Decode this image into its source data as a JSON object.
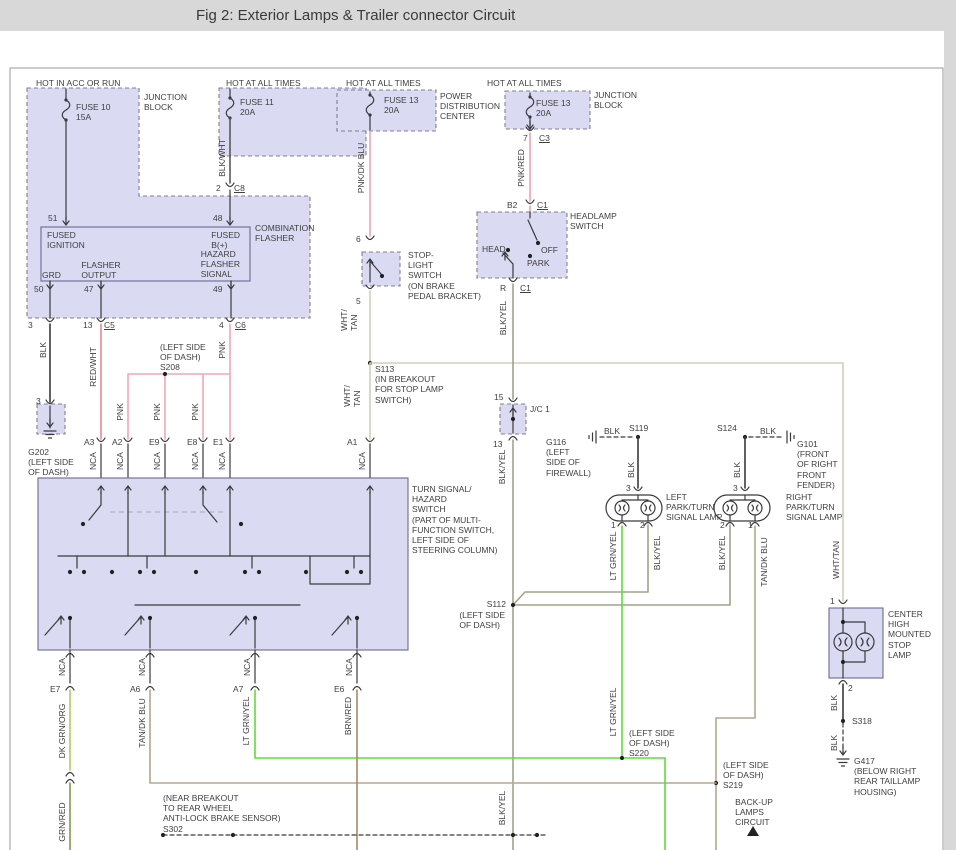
{
  "header": {
    "title": "Fig 2: Exterior Lamps & Trailer connector Circuit"
  },
  "colors": {
    "lav": "#dadaf2",
    "blk": "#3a3a3a",
    "bw": "#5a5a5a",
    "pnk": "#f0a6b4",
    "prd": "#efa0a8",
    "pdb": "#eda4b8",
    "rw": "#ea8890",
    "wt": "#d5cdb6",
    "by": "#a2a28c",
    "tdb": "#b5a78c",
    "lgy": "#5bdd3a",
    "dgo": "#a4d05c",
    "brd": "#ab8a5c",
    "gr2": "#7d9c46"
  },
  "labels": [
    {
      "n": "figure-title",
      "t": "Fig 2: Exterior Lamps & Trailer connector Circuit",
      "x": 196,
      "y": 7,
      "big": 1
    },
    {
      "n": "hot-in-acc-or-run",
      "t": "HOT IN ACC OR RUN",
      "x": 36,
      "y": 78
    },
    {
      "n": "junction-block-1",
      "t": "JUNCTION\nBLOCK",
      "x": 144,
      "y": 92
    },
    {
      "n": "fuse-10",
      "t": "FUSE 10\n15A",
      "x": 76,
      "y": 102
    },
    {
      "n": "hot-at-all-times-1",
      "t": "HOT AT ALL TIMES",
      "x": 226,
      "y": 78
    },
    {
      "n": "fuse-11",
      "t": "FUSE 11\n20A",
      "x": 240,
      "y": 97
    },
    {
      "n": "wire-blk-wht",
      "t": "BLK/WHT",
      "x": 222,
      "y": 158,
      "r": 1
    },
    {
      "n": "pin-2",
      "t": "2",
      "x": 216,
      "y": 183
    },
    {
      "n": "conn-c8",
      "t": "C8",
      "x": 234,
      "y": 183,
      "u": 1
    },
    {
      "n": "pin-51",
      "t": "51",
      "x": 48,
      "y": 213
    },
    {
      "n": "pin-48",
      "t": "48",
      "x": 213,
      "y": 213
    },
    {
      "n": "combination-flasher",
      "t": "COMBINATION\nFLASHER",
      "x": 255,
      "y": 223
    },
    {
      "n": "fused-ignition",
      "t": "FUSED\nIGNITION",
      "x": 47,
      "y": 230
    },
    {
      "n": "fused-b-plus",
      "t": "FUSED\nB(+)",
      "x": 240,
      "y": 230,
      "a": "r"
    },
    {
      "n": "hazard-flasher-signal",
      "t": "HAZARD\nFLASHER\nSIGNAL",
      "x": 240,
      "y": 249,
      "a": "r"
    },
    {
      "n": "flasher-output",
      "t": "FLASHER\nOUTPUT",
      "x": 101,
      "y": 260,
      "a": "c"
    },
    {
      "n": "grd",
      "t": "GRD",
      "x": 42,
      "y": 270
    },
    {
      "n": "pin-50",
      "t": "50",
      "x": 34,
      "y": 284
    },
    {
      "n": "pin-47",
      "t": "47",
      "x": 84,
      "y": 284
    },
    {
      "n": "pin-49",
      "t": "49",
      "x": 213,
      "y": 284
    },
    {
      "n": "pin-3-flasher",
      "t": "3",
      "x": 28,
      "y": 320
    },
    {
      "n": "pin-13-c5",
      "t": "13",
      "x": 83,
      "y": 320
    },
    {
      "n": "conn-c5",
      "t": "C5",
      "x": 104,
      "y": 320,
      "u": 1
    },
    {
      "n": "pin-4-c6",
      "t": "4",
      "x": 219,
      "y": 320
    },
    {
      "n": "conn-c6",
      "t": "C6",
      "x": 235,
      "y": 320,
      "u": 1
    },
    {
      "n": "wire-blk-g202",
      "t": "BLK",
      "x": 43,
      "y": 350,
      "r": 1
    },
    {
      "n": "wire-red-wht",
      "t": "RED/WHT",
      "x": 93,
      "y": 367,
      "r": 1
    },
    {
      "n": "splice-s208",
      "t": "(LEFT SIDE\nOF DASH)\nS208",
      "x": 160,
      "y": 342
    },
    {
      "n": "wire-pnk-c6",
      "t": "PNK",
      "x": 222,
      "y": 350,
      "r": 1
    },
    {
      "n": "wire-pnk-a2",
      "t": "PNK",
      "x": 120,
      "y": 412,
      "r": 1
    },
    {
      "n": "wire-pnk-e9",
      "t": "PNK",
      "x": 157,
      "y": 412,
      "r": 1
    },
    {
      "n": "wire-pnk-e8",
      "t": "PNK",
      "x": 195,
      "y": 412,
      "r": 1
    },
    {
      "n": "pin-3-g202",
      "t": "3",
      "x": 36,
      "y": 396
    },
    {
      "n": "ground-g202",
      "t": "G202\n(LEFT SIDE\nOF DASH)",
      "x": 51,
      "y": 447,
      "a": "c"
    },
    {
      "n": "conn-a3",
      "t": "A3",
      "x": 84,
      "y": 437
    },
    {
      "n": "conn-a2",
      "t": "A2",
      "x": 112,
      "y": 437
    },
    {
      "n": "conn-e9",
      "t": "E9",
      "x": 149,
      "y": 437
    },
    {
      "n": "conn-e8",
      "t": "E8",
      "x": 187,
      "y": 437
    },
    {
      "n": "conn-e1",
      "t": "E1",
      "x": 213,
      "y": 437
    },
    {
      "n": "wire-nca-a3",
      "t": "NCA",
      "x": 93,
      "y": 461,
      "r": 1
    },
    {
      "n": "wire-nca-a2",
      "t": "NCA",
      "x": 120,
      "y": 461,
      "r": 1
    },
    {
      "n": "wire-nca-e9",
      "t": "NCA",
      "x": 157,
      "y": 461,
      "r": 1
    },
    {
      "n": "wire-nca-e8",
      "t": "NCA",
      "x": 195,
      "y": 461,
      "r": 1
    },
    {
      "n": "wire-nca-e1",
      "t": "NCA",
      "x": 222,
      "y": 461,
      "r": 1
    },
    {
      "n": "wire-nca-a1",
      "t": "NCA",
      "x": 362,
      "y": 461,
      "r": 1
    },
    {
      "n": "conn-a1",
      "t": "A1",
      "x": 347,
      "y": 437
    },
    {
      "n": "splice-s113",
      "t": "S113\n(IN BREAKOUT\nFOR STOP LAMP\nSWITCH)",
      "x": 375,
      "y": 364
    },
    {
      "n": "wire-wht-tan-a1",
      "t": "WHT/\nTAN",
      "x": 352,
      "y": 396,
      "r": 1
    },
    {
      "n": "wire-wht-tan-5",
      "t": "WHT/\nTAN",
      "x": 349,
      "y": 320,
      "r": 1
    },
    {
      "n": "hot-at-all-times-2",
      "t": "HOT AT ALL TIMES",
      "x": 346,
      "y": 78
    },
    {
      "n": "fuse-13-pdc",
      "t": "FUSE 13\n20A",
      "x": 384,
      "y": 95
    },
    {
      "n": "power-distribution-center",
      "t": "POWER\nDISTRIBUTION\nCENTER",
      "x": 440,
      "y": 91
    },
    {
      "n": "wire-pnk-dk-blu",
      "t": "PNK/DK BLU",
      "x": 361,
      "y": 168,
      "r": 1
    },
    {
      "n": "pin-6",
      "t": "6",
      "x": 356,
      "y": 234
    },
    {
      "n": "stop-light-switch",
      "t": "STOP-\nLIGHT\nSWITCH\n(ON BRAKE\nPEDAL BRACKET)",
      "x": 408,
      "y": 250
    },
    {
      "n": "pin-5",
      "t": "5",
      "x": 356,
      "y": 296
    },
    {
      "n": "hot-at-all-times-3",
      "t": "HOT AT ALL TIMES",
      "x": 487,
      "y": 78
    },
    {
      "n": "fuse-13-jb",
      "t": "FUSE 13\n20A",
      "x": 536,
      "y": 98
    },
    {
      "n": "junction-block-2",
      "t": "JUNCTION\nBLOCK",
      "x": 594,
      "y": 90
    },
    {
      "n": "pin-7",
      "t": "7",
      "x": 523,
      "y": 133
    },
    {
      "n": "conn-c3",
      "t": "C3",
      "x": 539,
      "y": 133,
      "u": 1
    },
    {
      "n": "wire-pnk-red",
      "t": "PNK/RED",
      "x": 521,
      "y": 168,
      "r": 1
    },
    {
      "n": "pin-b2",
      "t": "B2",
      "x": 507,
      "y": 200
    },
    {
      "n": "conn-c1-top",
      "t": "C1",
      "x": 537,
      "y": 200,
      "u": 1
    },
    {
      "n": "headlamp-switch",
      "t": "HEADLAMP\nSWITCH",
      "x": 570,
      "y": 211
    },
    {
      "n": "head-position",
      "t": "HEAD",
      "x": 482,
      "y": 244
    },
    {
      "n": "off-position",
      "t": "OFF",
      "x": 541,
      "y": 245
    },
    {
      "n": "park-position",
      "t": "PARK",
      "x": 527,
      "y": 258
    },
    {
      "n": "pin-r",
      "t": "R",
      "x": 500,
      "y": 283
    },
    {
      "n": "conn-c1-bottom",
      "t": "C1",
      "x": 520,
      "y": 283,
      "u": 1
    },
    {
      "n": "wire-blk-yel-top",
      "t": "BLK/YEL",
      "x": 503,
      "y": 318,
      "r": 1
    },
    {
      "n": "pin-15",
      "t": "15",
      "x": 494,
      "y": 392
    },
    {
      "n": "junction-connector-1",
      "t": "J/C 1",
      "x": 530,
      "y": 404
    },
    {
      "n": "pin-13-jc1",
      "t": "13",
      "x": 493,
      "y": 439
    },
    {
      "n": "wire-blk-yel-mid",
      "t": "BLK/YEL",
      "x": 502,
      "y": 467,
      "r": 1
    },
    {
      "n": "ground-g116",
      "t": "G116\n(LEFT\nSIDE OF\nFIREWALL)",
      "x": 591,
      "y": 437,
      "a": "r"
    },
    {
      "n": "wire-blk-s119",
      "t": "BLK",
      "x": 604,
      "y": 426
    },
    {
      "n": "splice-s119",
      "t": "S119",
      "x": 629,
      "y": 423
    },
    {
      "n": "wire-blk-left-lamp",
      "t": "BLK",
      "x": 631,
      "y": 470,
      "r": 1
    },
    {
      "n": "pin-3-left-lamp",
      "t": "3",
      "x": 626,
      "y": 483
    },
    {
      "n": "left-park-turn-lamp",
      "t": "LEFT\nPARK/TURN\nSIGNAL LAMP",
      "x": 666,
      "y": 492
    },
    {
      "n": "pin-1-left-lamp",
      "t": "1",
      "x": 611,
      "y": 520
    },
    {
      "n": "pin-2-left-lamp",
      "t": "2",
      "x": 640,
      "y": 520
    },
    {
      "n": "wire-lt-grn-yel-left",
      "t": "LT GRN/YEL",
      "x": 613,
      "y": 556,
      "r": 1
    },
    {
      "n": "wire-blk-yel-left",
      "t": "BLK/YEL",
      "x": 657,
      "y": 553,
      "r": 1
    },
    {
      "n": "splice-s124",
      "t": "S124",
      "x": 717,
      "y": 423
    },
    {
      "n": "wire-blk-s124",
      "t": "BLK",
      "x": 760,
      "y": 426
    },
    {
      "n": "ground-g101",
      "t": "G101\n(FRONT\nOF RIGHT\nFRONT\nFENDER)",
      "x": 797,
      "y": 439
    },
    {
      "n": "wire-blk-right-lamp",
      "t": "BLK",
      "x": 737,
      "y": 470,
      "r": 1
    },
    {
      "n": "pin-3-right-lamp",
      "t": "3",
      "x": 733,
      "y": 483
    },
    {
      "n": "right-park-turn-lamp",
      "t": "RIGHT\nPARK/TURN\nSIGNAL LAMP",
      "x": 786,
      "y": 492
    },
    {
      "n": "pin-2-right-lamp",
      "t": "2",
      "x": 720,
      "y": 520
    },
    {
      "n": "pin-1-right-lamp",
      "t": "1",
      "x": 748,
      "y": 520
    },
    {
      "n": "wire-blk-yel-right",
      "t": "BLK/YEL",
      "x": 722,
      "y": 553,
      "r": 1
    },
    {
      "n": "wire-tan-dk-blu-right",
      "t": "TAN/DK BLU",
      "x": 764,
      "y": 562,
      "r": 1
    },
    {
      "n": "wire-wht-tan-chmsl",
      "t": "WHT/TAN",
      "x": 836,
      "y": 560,
      "r": 1
    },
    {
      "n": "turn-signal-hazard-switch",
      "t": "TURN SIGNAL/\nHAZARD\nSWITCH\n(PART OF MULTI-\nFUNCTION SWITCH,\nLEFT SIDE OF\nSTEERING COLUMN)",
      "x": 412,
      "y": 484
    },
    {
      "n": "wire-nca-e7",
      "t": "NCA",
      "x": 62,
      "y": 667,
      "r": 1
    },
    {
      "n": "wire-nca-a6",
      "t": "NCA",
      "x": 142,
      "y": 667,
      "r": 1
    },
    {
      "n": "wire-nca-a7",
      "t": "NCA",
      "x": 247,
      "y": 667,
      "r": 1
    },
    {
      "n": "wire-nca-e6",
      "t": "NCA",
      "x": 349,
      "y": 667,
      "r": 1
    },
    {
      "n": "conn-e7",
      "t": "E7",
      "x": 50,
      "y": 684
    },
    {
      "n": "conn-a6",
      "t": "A6",
      "x": 130,
      "y": 684
    },
    {
      "n": "conn-a7",
      "t": "A7",
      "x": 233,
      "y": 684
    },
    {
      "n": "conn-e6",
      "t": "E6",
      "x": 334,
      "y": 684
    },
    {
      "n": "wire-dk-grn-org",
      "t": "DK GRN/ORG",
      "x": 62,
      "y": 731,
      "r": 1
    },
    {
      "n": "wire-tan-dk-blu-a6",
      "t": "TAN/DK BLU",
      "x": 142,
      "y": 723,
      "r": 1
    },
    {
      "n": "wire-lt-grn-yel-a7",
      "t": "LT GRN/YEL",
      "x": 246,
      "y": 721,
      "r": 1
    },
    {
      "n": "wire-brn-red",
      "t": "BRN/RED",
      "x": 348,
      "y": 716,
      "r": 1
    },
    {
      "n": "wire-grn-red",
      "t": "GRN/RED",
      "x": 62,
      "y": 822,
      "r": 1
    },
    {
      "n": "splice-s302",
      "t": "(NEAR BREAKOUT\nTO REAR WHEEL\nANTI-LOCK BRAKE SENSOR)\nS302",
      "x": 163,
      "y": 793
    },
    {
      "n": "wire-lt-grn-yel-mid",
      "t": "LT GRN/YEL",
      "x": 613,
      "y": 712,
      "r": 1
    },
    {
      "n": "splice-s220",
      "t": "(LEFT SIDE\nOF DASH)\nS220",
      "x": 629,
      "y": 728
    },
    {
      "n": "splice-s112",
      "t": "S112",
      "x": 506,
      "y": 599,
      "a": "r"
    },
    {
      "n": "splice-s112-loc",
      "t": "(LEFT SIDE\nOF DASH)",
      "x": 505,
      "y": 610,
      "a": "r"
    },
    {
      "n": "wire-blk-yel-bottom",
      "t": "BLK/YEL",
      "x": 502,
      "y": 808,
      "r": 1
    },
    {
      "n": "splice-s219",
      "t": "(LEFT SIDE\nOF DASH)\nS219",
      "x": 723,
      "y": 760
    },
    {
      "n": "backup-lamps-circuit",
      "t": "BACK-UP\nLAMPS\nCIRCUIT",
      "x": 754,
      "y": 797,
      "a": "c"
    },
    {
      "n": "pin-1-chmsl",
      "t": "1",
      "x": 830,
      "y": 596
    },
    {
      "n": "center-high-mounted-stop-lamp",
      "t": "CENTER\nHIGH\nMOUNTED\nSTOP\nLAMP",
      "x": 888,
      "y": 609
    },
    {
      "n": "pin-2-chmsl",
      "t": "2",
      "x": 848,
      "y": 683
    },
    {
      "n": "wire-blk-chmsl",
      "t": "BLK",
      "x": 834,
      "y": 703,
      "r": 1
    },
    {
      "n": "splice-s318",
      "t": "S318",
      "x": 852,
      "y": 716
    },
    {
      "n": "wire-blk-g417",
      "t": "BLK",
      "x": 834,
      "y": 743,
      "r": 1
    },
    {
      "n": "ground-g417",
      "t": "G417\n(BELOW RIGHT\nREAR TAILLAMP\nHOUSING)",
      "x": 854,
      "y": 756
    }
  ]
}
